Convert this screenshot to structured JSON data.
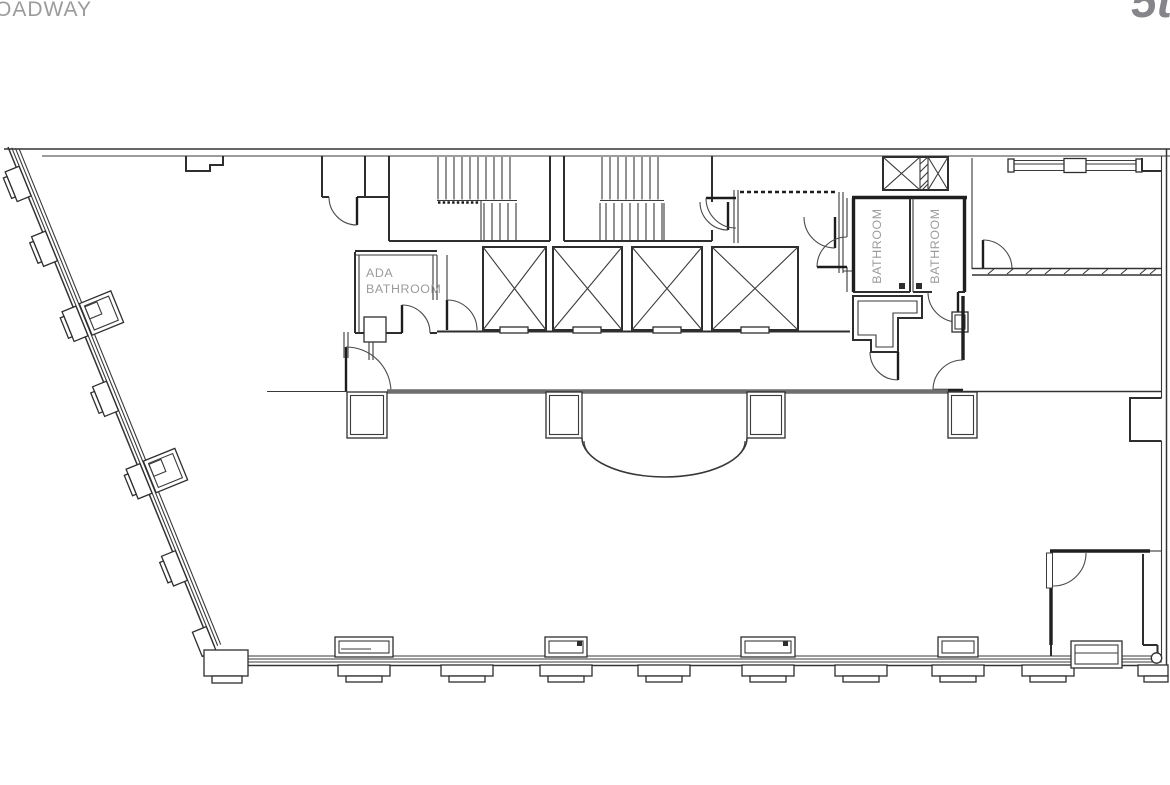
{
  "header": {
    "street_label": "OADWAY",
    "floor_label": "5t"
  },
  "plan": {
    "labels": {
      "ada_bathroom_line1": "ADA",
      "ada_bathroom_line2": "BATHROOM",
      "bathroom_left": "BATHROOM",
      "bathroom_right": "BATHROOM"
    },
    "colors": {
      "background": "#ffffff",
      "line_dark": "#2e2e2e",
      "wall_black": "#1f1f1f",
      "corridor_wall_gray": "#6f6f6f",
      "label_gray": "#9b9b9b",
      "floor_number_gray": "#85858a"
    }
  }
}
